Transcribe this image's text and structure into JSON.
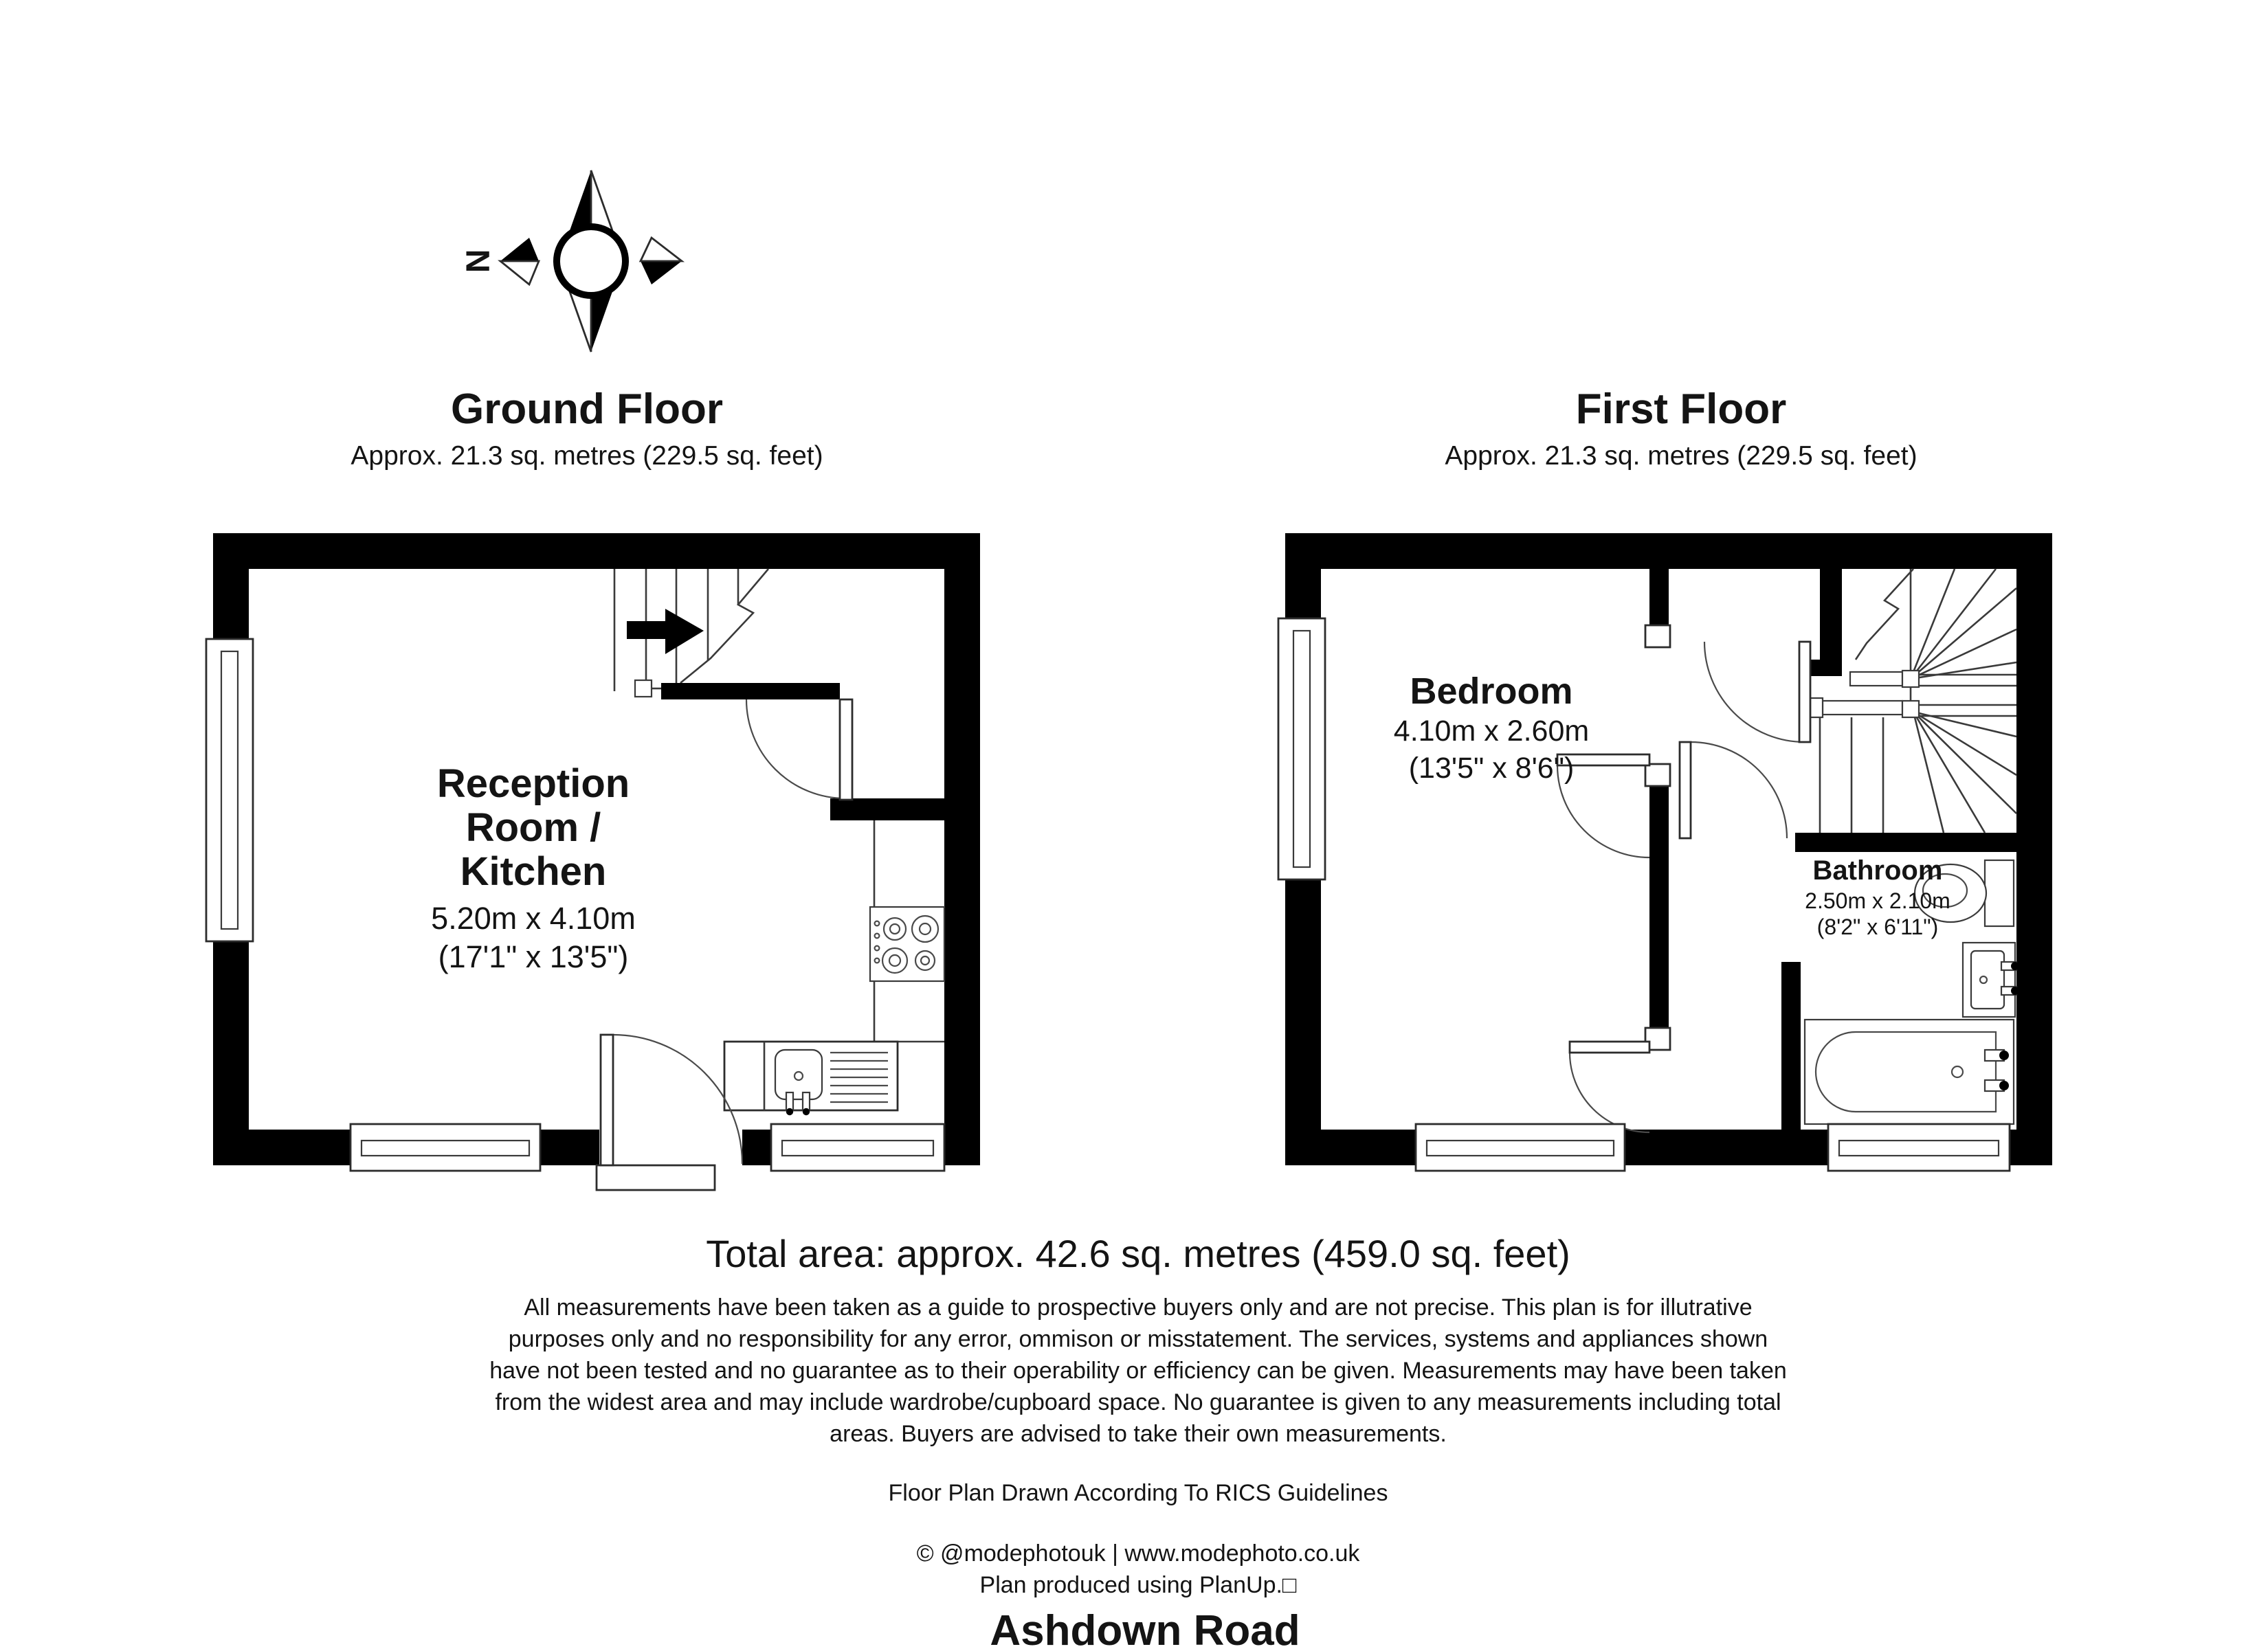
{
  "compass": {
    "north_label": "N"
  },
  "ground_floor": {
    "title": "Ground Floor",
    "subtitle": "Approx. 21.3 sq. metres (229.5 sq. feet)",
    "room": {
      "name_lines": [
        "Reception",
        "Room /",
        "Kitchen"
      ],
      "dimensions_metric": "5.20m x 4.10m",
      "dimensions_imperial": "(17'1\" x 13'5\")"
    }
  },
  "first_floor": {
    "title": "First Floor",
    "subtitle": "Approx. 21.3 sq. metres (229.5 sq. feet)",
    "bedroom": {
      "name": "Bedroom",
      "dimensions_metric": "4.10m x 2.60m",
      "dimensions_imperial": "(13'5\" x 8'6\")"
    },
    "bathroom": {
      "name": "Bathroom",
      "dimensions_metric": "2.50m x 2.10m",
      "dimensions_imperial": "(8'2\" x 6'11\")"
    }
  },
  "footer": {
    "total_area": "Total area: approx. 42.6 sq. metres (459.0 sq. feet)",
    "disclaimer_lines": [
      "All measurements have been taken as a guide to prospective buyers only and are not precise. This plan is for illutrative",
      "purposes only and no responsibility for any error, ommison or misstatement. The services, systems and appliances shown",
      "have not been tested and no guarantee as to their operability or efficiency can be given. Measurements may have been taken",
      "from the widest area and may include wardrobe/cupboard space. No guarantee is given to any measurements including total",
      "areas. Buyers are advised to take their own measurements."
    ],
    "rics_line": "Floor Plan Drawn According To RICS Guidelines",
    "copyright_line": "© @modephotouk | www.modephoto.co.uk",
    "produced_line": "Plan produced using PlanUp.□",
    "address": "Ashdown Road"
  }
}
